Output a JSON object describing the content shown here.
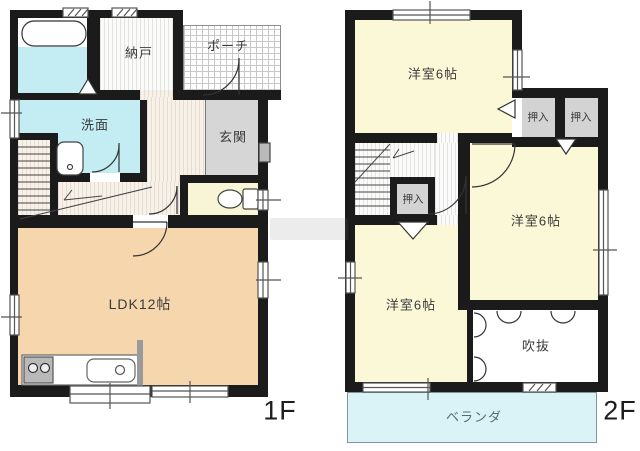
{
  "floor1": {
    "floor_label": "1F",
    "rooms": {
      "nando": "納戸",
      "porch": "ポーチ",
      "senmen": "洗面",
      "genkan": "玄関",
      "ldk": "LDK12帖"
    }
  },
  "floor2": {
    "floor_label": "2F",
    "rooms": {
      "yoshitsu_top": "洋室6帖",
      "yoshitsu_mid": "洋室6帖",
      "yoshitsu_bottom": "洋室6帖",
      "oshiire": "押入",
      "fukinuke": "吹抜",
      "veranda": "ベランダ"
    }
  },
  "colors": {
    "wall": "#1b1b1b",
    "ldk": "#f6d7ad",
    "bedroom": "#fbf8d8",
    "water": "#c3ecf3",
    "veranda": "#daf3f7",
    "entry_gray": "#d6d6d6",
    "closet_gray": "#d3d3d3",
    "toilet": "#f8f4d6"
  }
}
